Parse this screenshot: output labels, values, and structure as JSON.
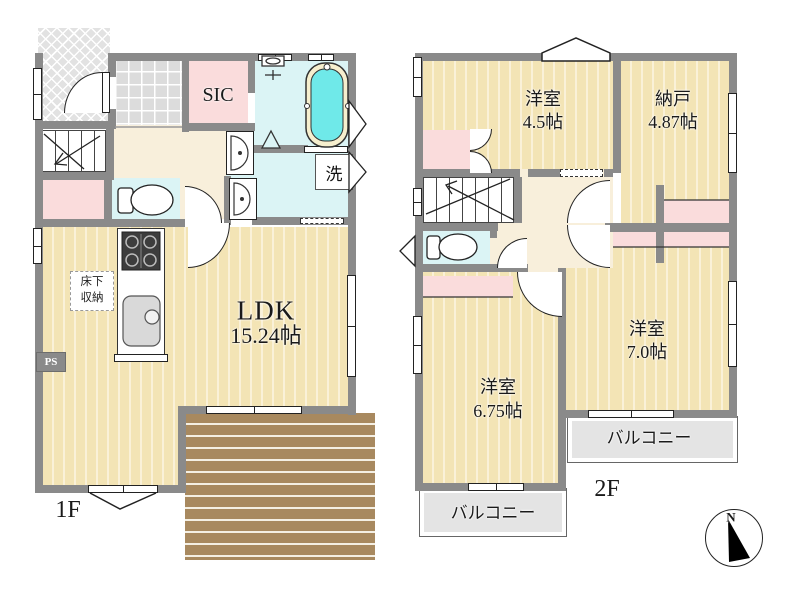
{
  "floor1": {
    "label": "1F",
    "ldk_name": "LDK",
    "ldk_size": "15.24帖",
    "sic": "SIC",
    "laundry": "洗",
    "underfloor_line1": "床下",
    "underfloor_line2": "収納",
    "pipe_space": "PS"
  },
  "floor2": {
    "label": "2F",
    "bedroom45_name": "洋室",
    "bedroom45_size": "4.5帖",
    "nando_name": "納戸",
    "nando_size": "4.87帖",
    "bedroom70_name": "洋室",
    "bedroom70_size": "7.0帖",
    "bedroom675_name": "洋室",
    "bedroom675_size": "6.75帖",
    "balcony_left": "バルコニー",
    "balcony_right": "バルコニー"
  },
  "compass_north": "N",
  "colors": {
    "wall": "#8A8A8A",
    "floor": "#F3E4B5",
    "hall": "#F8EFDB",
    "pink": "#FADCDC",
    "cyan": "#DBF4F5",
    "bathtub": "#6FE9E9",
    "deck": "#A8895F",
    "balcony": "#E4E4E4"
  }
}
